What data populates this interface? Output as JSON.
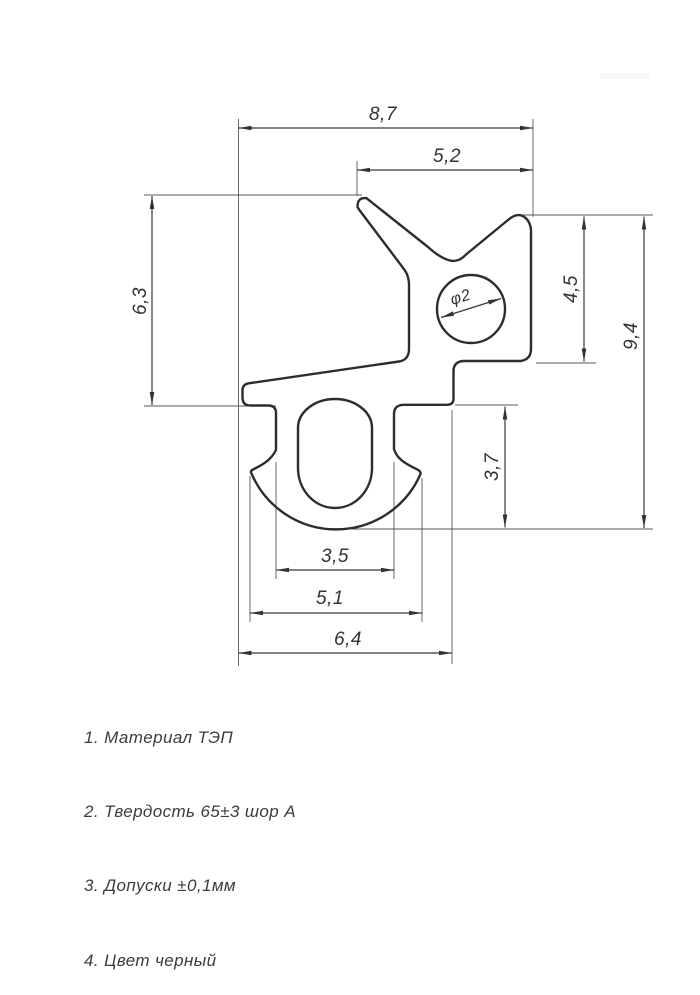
{
  "drawing": {
    "dimensions": {
      "top_width": "8,7",
      "fork_width": "5,2",
      "left_height": "6,3",
      "hole_diameter": "φ2",
      "upper_right_height": "4,5",
      "overall_height": "9,4",
      "lower_right_height": "3,7",
      "foot_width": "3,5",
      "barb_width": "5,1",
      "base_width": "6,4"
    },
    "notes": [
      "1. Материал ТЭП",
      "2. Твердость 65±3 шор А",
      "3. Допуски ±0,1мм",
      "4. Цвет черный"
    ],
    "colors": {
      "background": "#ffffff",
      "profile_line": "#2d2d2d",
      "dimension_line": "#383838",
      "text": "#333333"
    }
  }
}
